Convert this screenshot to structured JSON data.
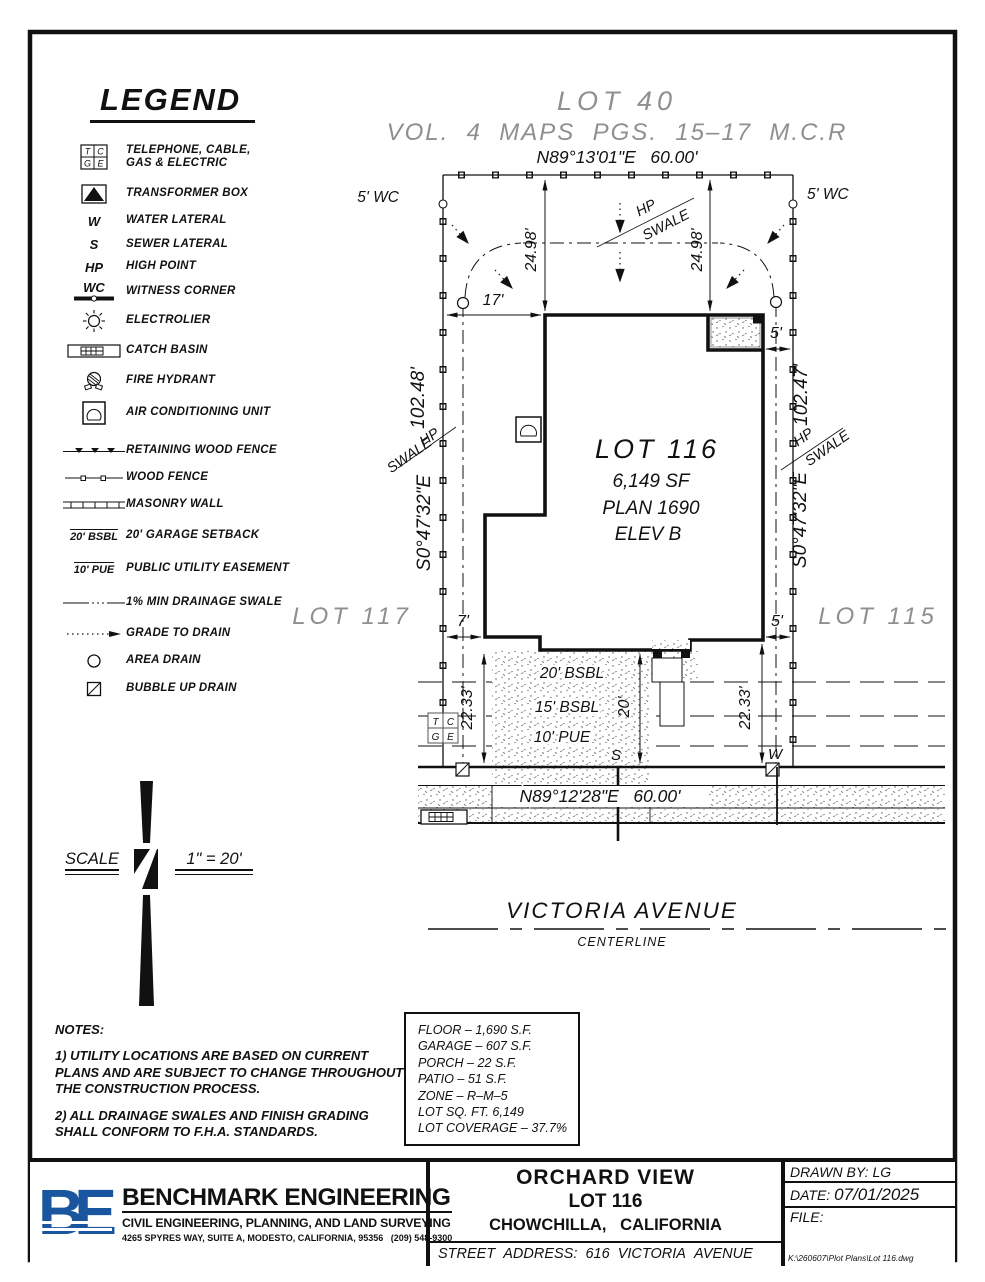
{
  "legend": {
    "title": "LEGEND",
    "items": [
      {
        "icon": "tcge-icon",
        "label": "TELEPHONE, CABLE, GAS & ELECTRIC"
      },
      {
        "icon": "transformer-icon",
        "label": "TRANSFORMER BOX"
      },
      {
        "icon": "water-lateral-symbol",
        "sym": "W",
        "label": "WATER LATERAL"
      },
      {
        "icon": "sewer-lateral-symbol",
        "sym": "S",
        "label": "SEWER LATERAL"
      },
      {
        "icon": "high-point-symbol",
        "sym": "HP",
        "label": "HIGH POINT"
      },
      {
        "icon": "witness-corner-symbol",
        "sym": "WC",
        "label": "WITNESS CORNER"
      },
      {
        "icon": "electrolier-icon",
        "label": "ELECTROLIER"
      },
      {
        "icon": "catch-basin-icon",
        "label": "CATCH BASIN"
      },
      {
        "icon": "fire-hydrant-icon",
        "label": "FIRE HYDRANT"
      },
      {
        "icon": "ac-unit-icon",
        "label": "AIR CONDITIONING UNIT"
      },
      {
        "icon": "retaining-wood-fence-icon",
        "label": "RETAINING WOOD FENCE"
      },
      {
        "icon": "wood-fence-icon",
        "label": "WOOD FENCE"
      },
      {
        "icon": "masonry-wall-icon",
        "label": "MASONRY WALL"
      },
      {
        "icon": "garage-setback-symbol",
        "sym": "20' BSBL",
        "label": "20' GARAGE SETBACK"
      },
      {
        "icon": "pue-symbol",
        "sym": "10' PUE",
        "label": "PUBLIC UTILITY EASEMENT"
      },
      {
        "icon": "drainage-swale-icon",
        "label": "1% MIN DRAINAGE SWALE"
      },
      {
        "icon": "grade-to-drain-icon",
        "label": "GRADE TO DRAIN"
      },
      {
        "icon": "area-drain-icon",
        "label": "AREA DRAIN"
      },
      {
        "icon": "bubble-up-drain-icon",
        "label": "BUBBLE UP DRAIN"
      }
    ]
  },
  "plan": {
    "lot40": "LOT 40",
    "map_ref": "VOL.  4  MAPS  PGS.  15–17  M.C.R",
    "bearing_top": "N89°13'01\"E   60.00'",
    "bearing_bottom": "N89°12'28\"E   60.00'",
    "wc": "5' WC",
    "dim_2498": "24.98'",
    "dim_17": "17'",
    "dim_5": "5'",
    "dim_7": "7'",
    "dim_2233": "22.33'",
    "dim_20": "20'",
    "len_left": "102.48'",
    "len_right": "102.47'",
    "bearing_side": "S0°47'32\"E",
    "hp": "HP",
    "swale": "SWALE",
    "lot117": "LOT 117",
    "lot115": "LOT 115",
    "lot116": "LOT 116",
    "lot116_sf": "6,149 SF",
    "lot116_plan": "PLAN 1690",
    "lot116_elev": "ELEV B",
    "bsbl20": "20' BSBL",
    "bsbl15": "15' BSBL",
    "pue10": "10' PUE",
    "s": "S",
    "w": "W",
    "t": "T",
    "c": "C",
    "g": "G",
    "e": "E",
    "street": "VICTORIA AVENUE",
    "centerline": "CENTERLINE"
  },
  "scale": {
    "label": "SCALE",
    "value": "1\" = 20'"
  },
  "notes": {
    "heading": "NOTES:",
    "note1": "1) UTILITY LOCATIONS ARE BASED ON CURRENT PLANS AND ARE SUBJECT TO CHANGE THROUGHOUT THE CONSTRUCTION PROCESS.",
    "note2": "2) ALL DRAINAGE SWALES AND FINISH GRADING SHALL CONFORM TO F.H.A. STANDARDS."
  },
  "area_table": {
    "rows": [
      "FLOOR – 1,690 S.F.",
      "GARAGE – 607 S.F.",
      "PORCH – 22 S.F.",
      "PATIO – 51 S.F.",
      "ZONE – R–M–5",
      "LOT SQ. FT. 6,149",
      "LOT COVERAGE – 37.7%"
    ]
  },
  "titleblock": {
    "logo_letters": "BE",
    "company": "BENCHMARK ENGINEERING",
    "tagline": "CIVIL ENGINEERING, PLANNING, AND LAND SURVEYING",
    "address": "4265 SPYRES WAY, SUITE A, MODESTO, CALIFORNIA, 95356   (209) 548-9300",
    "project": "ORCHARD VIEW",
    "lot": "LOT 116",
    "city": "CHOWCHILLA,   CALIFORNIA",
    "street_address": "STREET  ADDRESS:  616  VICTORIA  AVENUE",
    "drawn_by_label": "DRAWN BY:",
    "drawn_by": "LG",
    "date_label": "DATE:",
    "date": "07/01/2025",
    "file_label": "FILE:",
    "file_path": "K:\\260607\\Plot Plans\\Lot 116.dwg"
  }
}
